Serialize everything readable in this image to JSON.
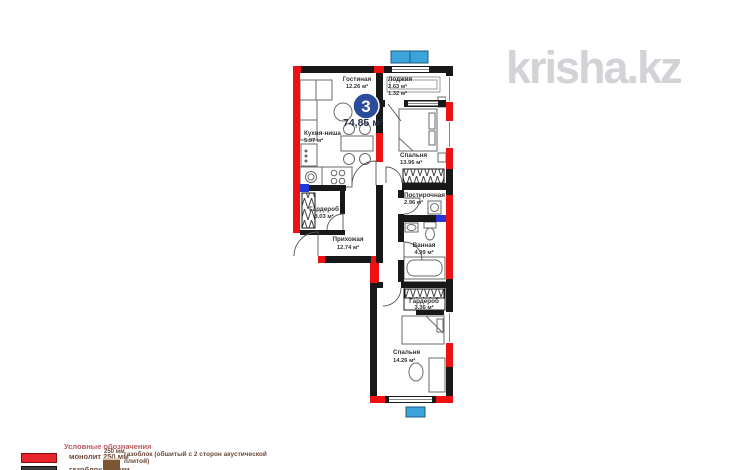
{
  "watermark": "krisha.kz",
  "unit": {
    "number": "3",
    "total_area": "74,85 м²"
  },
  "rooms": [
    {
      "name": "Гостиная",
      "area": "12.26 м²"
    },
    {
      "name": "Лоджия",
      "area": "2.63 м²",
      "area2": "1.32 м²"
    },
    {
      "name": "Кухня-ниша",
      "area": "5.97 м²"
    },
    {
      "name": "Спальня",
      "area": "13.96 м²"
    },
    {
      "name": "Постирочная",
      "area": "2.96 м²"
    },
    {
      "name": "Гардероб",
      "area": "3.03 м²"
    },
    {
      "name": "Прихожая",
      "area": "12.74 м²"
    },
    {
      "name": "Ванная",
      "area": "4.99 м²"
    },
    {
      "name": "Гардероб",
      "area": "3.36 м²"
    },
    {
      "name": "Спальня",
      "area": "14.26 м²"
    }
  ],
  "legend": {
    "title": "Условные обозначения",
    "items": [
      {
        "label": "монолит 250 мм",
        "color": "#e8252a"
      },
      {
        "label": "газоблок 200 мм",
        "color": "#3a3a3a"
      },
      {
        "label": "газоблок (обшитый с 2 сторон акустической плитой)",
        "note": "250 мм",
        "color": "#7b5634"
      }
    ]
  },
  "colors": {
    "monolith_red": "#ee1111",
    "gasblock_black": "#181818",
    "acoustic_blue": "#2438d8",
    "window_marker_blue": "#3ba4da",
    "badge_blue": "#2b4c9b",
    "watermark_gray": "#d2d2d7"
  }
}
